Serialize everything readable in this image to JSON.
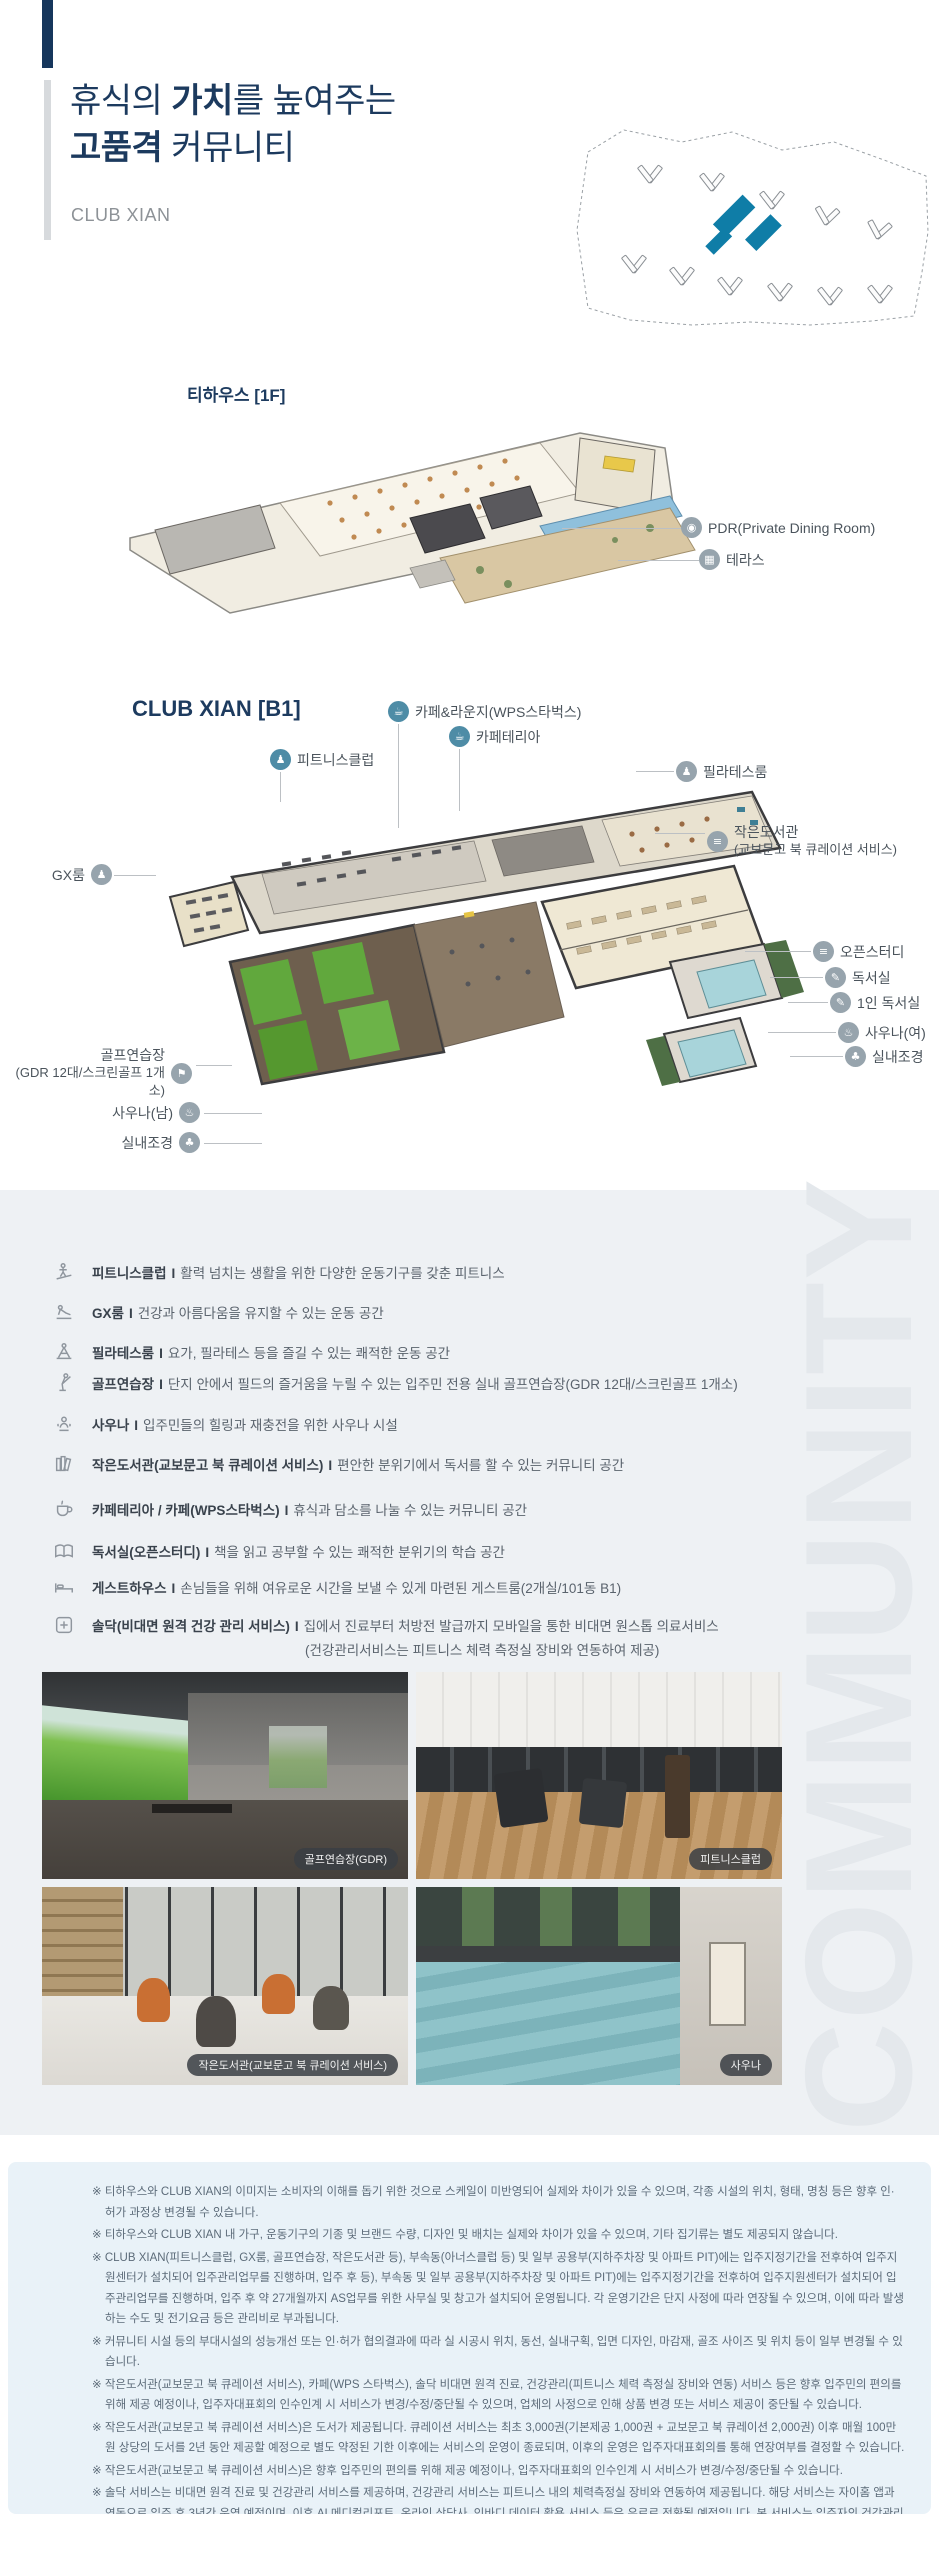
{
  "header": {
    "t1a": "휴식의 ",
    "t1b": "가치",
    "t1c": "를 높여주는",
    "t2a": "고품격",
    "t2b": " 커뮤니티",
    "subtitle": "CLUB XIAN"
  },
  "watermark": "COMMUNITY",
  "teahouse": {
    "title": "티하우스 [1F]",
    "callouts": [
      {
        "glyph": "◉",
        "label": "PDR(Private Dining Room)"
      },
      {
        "glyph": "▦",
        "label": "테라스"
      }
    ]
  },
  "b1": {
    "title": "CLUB XIAN [B1]",
    "top": [
      {
        "glyph": "☕",
        "label": "카페&라운지(WPS스타벅스)"
      },
      {
        "glyph": "☕",
        "label": "카페테리아"
      },
      {
        "glyph": "♟",
        "label": "피트니스클럽"
      }
    ],
    "right": [
      {
        "glyph": "♟",
        "label": "필라테스룸"
      },
      {
        "glyph": "≡",
        "label": "작은도서관",
        "sub": "(교보문고 북 큐레이션 서비스)"
      },
      {
        "glyph": "≡",
        "label": "오픈스터디"
      },
      {
        "glyph": "✎",
        "label": "독서실"
      },
      {
        "glyph": "✎",
        "label": "1인 독서실"
      },
      {
        "glyph": "♨",
        "label": "사우나(여)"
      },
      {
        "glyph": "♣",
        "label": "실내조경"
      }
    ],
    "left": [
      {
        "glyph": "♟",
        "label": "GX룸"
      },
      {
        "glyph": "⚑",
        "label": "골프연습장",
        "sub": "(GDR 12대/스크린골프 1개소)"
      },
      {
        "glyph": "♨",
        "label": "사우나(남)"
      },
      {
        "glyph": "♣",
        "label": "실내조경"
      }
    ]
  },
  "facilities": {
    "separator": "I",
    "items": [
      {
        "name": "피트니스클럽",
        "desc": "활력 넘치는 생활을 위한 다양한 운동기구를 갖춘 피트니스"
      },
      {
        "name": "GX룸",
        "desc": "건강과 아름다움을 유지할 수 있는 운동 공간"
      },
      {
        "name": "필라테스룸",
        "desc": "요가, 필라테스 등을 즐길 수 있는 쾌적한 운동 공간"
      },
      {
        "name": "골프연습장",
        "desc": "단지 안에서 필드의 즐거움을 누릴 수 있는 입주민 전용 실내 골프연습장(GDR 12대/스크린골프 1개소)"
      },
      {
        "name": "사우나",
        "desc": "입주민들의 힐링과 재충전을 위한 사우나 시설"
      },
      {
        "name": "작은도서관(교보문고 북 큐레이션 서비스)",
        "desc": "편안한 분위기에서 독서를 할 수 있는 커뮤니티 공간"
      },
      {
        "name": "카페테리아 / 카페(WPS스타벅스)",
        "desc": "휴식과 담소를 나눌 수 있는 커뮤니티 공간"
      },
      {
        "name": "독서실(오픈스터디)",
        "desc": "책을 읽고 공부할 수 있는 쾌적한 분위기의 학습 공간"
      },
      {
        "name": "게스트하우스",
        "desc": "손님들을 위해 여유로운 시간을 보낼 수 있게 마련된 게스트룸(2개실/101동 B1)"
      },
      {
        "name": "솔닥(비대면 원격 건강 관리 서비스)",
        "desc": "집에서 진료부터 처방전 발급까지 모바일을 통한 비대면 원스톱 의료서비스",
        "desc2": "(건강관리서비스는 피트니스 체력 측정실 장비와 연동하여 제공)"
      }
    ]
  },
  "photos": [
    {
      "caption": "골프연습장(GDR)"
    },
    {
      "caption": "피트니스클럽"
    },
    {
      "caption": "작은도서관(교보문고 북 큐레이션 서비스)"
    },
    {
      "caption": "사우나"
    }
  ],
  "disclaimer": {
    "lines": [
      "※ 티하우스와 CLUB XIAN의 이미지는 소비자의 이해를 돕기 위한 것으로 스케일이 미반영되어 실제와 차이가 있을 수 있으며, 각종 시설의 위치, 형태, 명칭 등은 향후 인·허가 과정상 변경될 수 있습니다.",
      "※ 티하우스와 CLUB XIAN 내 가구, 운동기구의 기종 및 브랜드 수량, 디자인 및 배치는 실제와 차이가 있을 수 있으며, 기타 집기류는 별도 제공되지 않습니다.",
      "※ CLUB XIAN(피트니스클럽, GX룸, 골프연습장, 작은도서관 등), 부속동(아너스클럽 등) 및 일부 공용부(지하주차장 및 아파트 PIT)에는 입주지정기간을 전후하여 입주지원센터가 설치되어 입주관리업무를 진행하며, 입주 후 등), 부속동 및 일부 공용부(지하주차장 및 아파트 PIT)에는 입주지정기간을 전후하여 입주지원센터가 설치되어 입주관리업무를 진행하며, 입주 후 약 27개월까지 AS업무를 위한 사무실 및 창고가 설치되어 운영됩니다. 각 운영기간은 단지 사정에 따라 연장될 수 있으며, 이에 따라 발생하는 수도 및 전기요금 등은 관리비로 부과됩니다.",
      "※ 커뮤니티 시설 등의 부대시설의 성능개선 또는 인·허가 협의결과에 따라 실 시공시 위치, 동선, 실내구획, 입면 디자인, 마감재, 골조 사이즈 및 위치 등이 일부 변경될 수 있습니다.",
      "※ 작은도서관(교보문고 북 큐레이션 서비스), 카페(WPS 스타벅스), 솔닥 비대면 원격 진료, 건강관리(피트니스 체력 측정실 장비와 연동) 서비스 등은 향후 입주민의 편의를 위해 제공 예정이나, 입주자대표회의 인수인계 시 서비스가 변경/수정/중단될 수 있으며, 업체의 사정으로 인해 상품 변경 또는 서비스 제공이 중단될 수 있습니다.",
      "※ 작은도서관(교보문고 북 큐레이션 서비스)은 도서가 제공됩니다. 큐레이션 서비스는 최초 3,000권(기본제공 1,000권 + 교보문고 북 큐레이션 2,000권) 이후 매월 100만원 상당의 도서를 2년 동안 제공할 예정으로 별도 약정된 기한 이후에는 서비스의 운영이 종료되며, 이후의 운영은 입주자대표회의를 통해 연장여부를 결정할 수 있습니다.",
      "※ 작은도서관(교보문고 북 큐레이션 서비스)은 향후 입주민의 편의를 위해 제공 예정이나, 입주자대표회의 인수인계 시 서비스가 변경/수정/중단될 수 있습니다.",
      "※ 솔닥 서비스는 비대면 원격 진료 및 건강관리 서비스를 제공하며, 건강관리 서비스는 피트니스 내의 체력측정실 장비와 연동하여 제공됩니다. 해당 서비스는 자이홈 앱과 연동으로 입주 후 3년간 운영 예정이며, 이후 AI 메디컬리포트, 온라인 상담사, 인바디 데이터 활용 서비스 등은 유료로 전환될 예정입니다. 본 서비스는 입주자의 건강관리 편의를 위한 부가 서비스로, 입주자대표회의 인수·인계 이후 또는 서비스 제공사 사정에 따라 서비스 내용이 변경되거나 중단될 수 있습니다.",
      "※ CLUB XIAN 등 기타 부대복리시설의 디자인, 창호, 마감재 등은 변경될 수 있습니다."
    ]
  },
  "colors": {
    "navy": "#16365c",
    "teal_building": "#0f7da7",
    "band_bg": "#eef1f4",
    "disclaimer_bg": "#e9f2f8"
  }
}
